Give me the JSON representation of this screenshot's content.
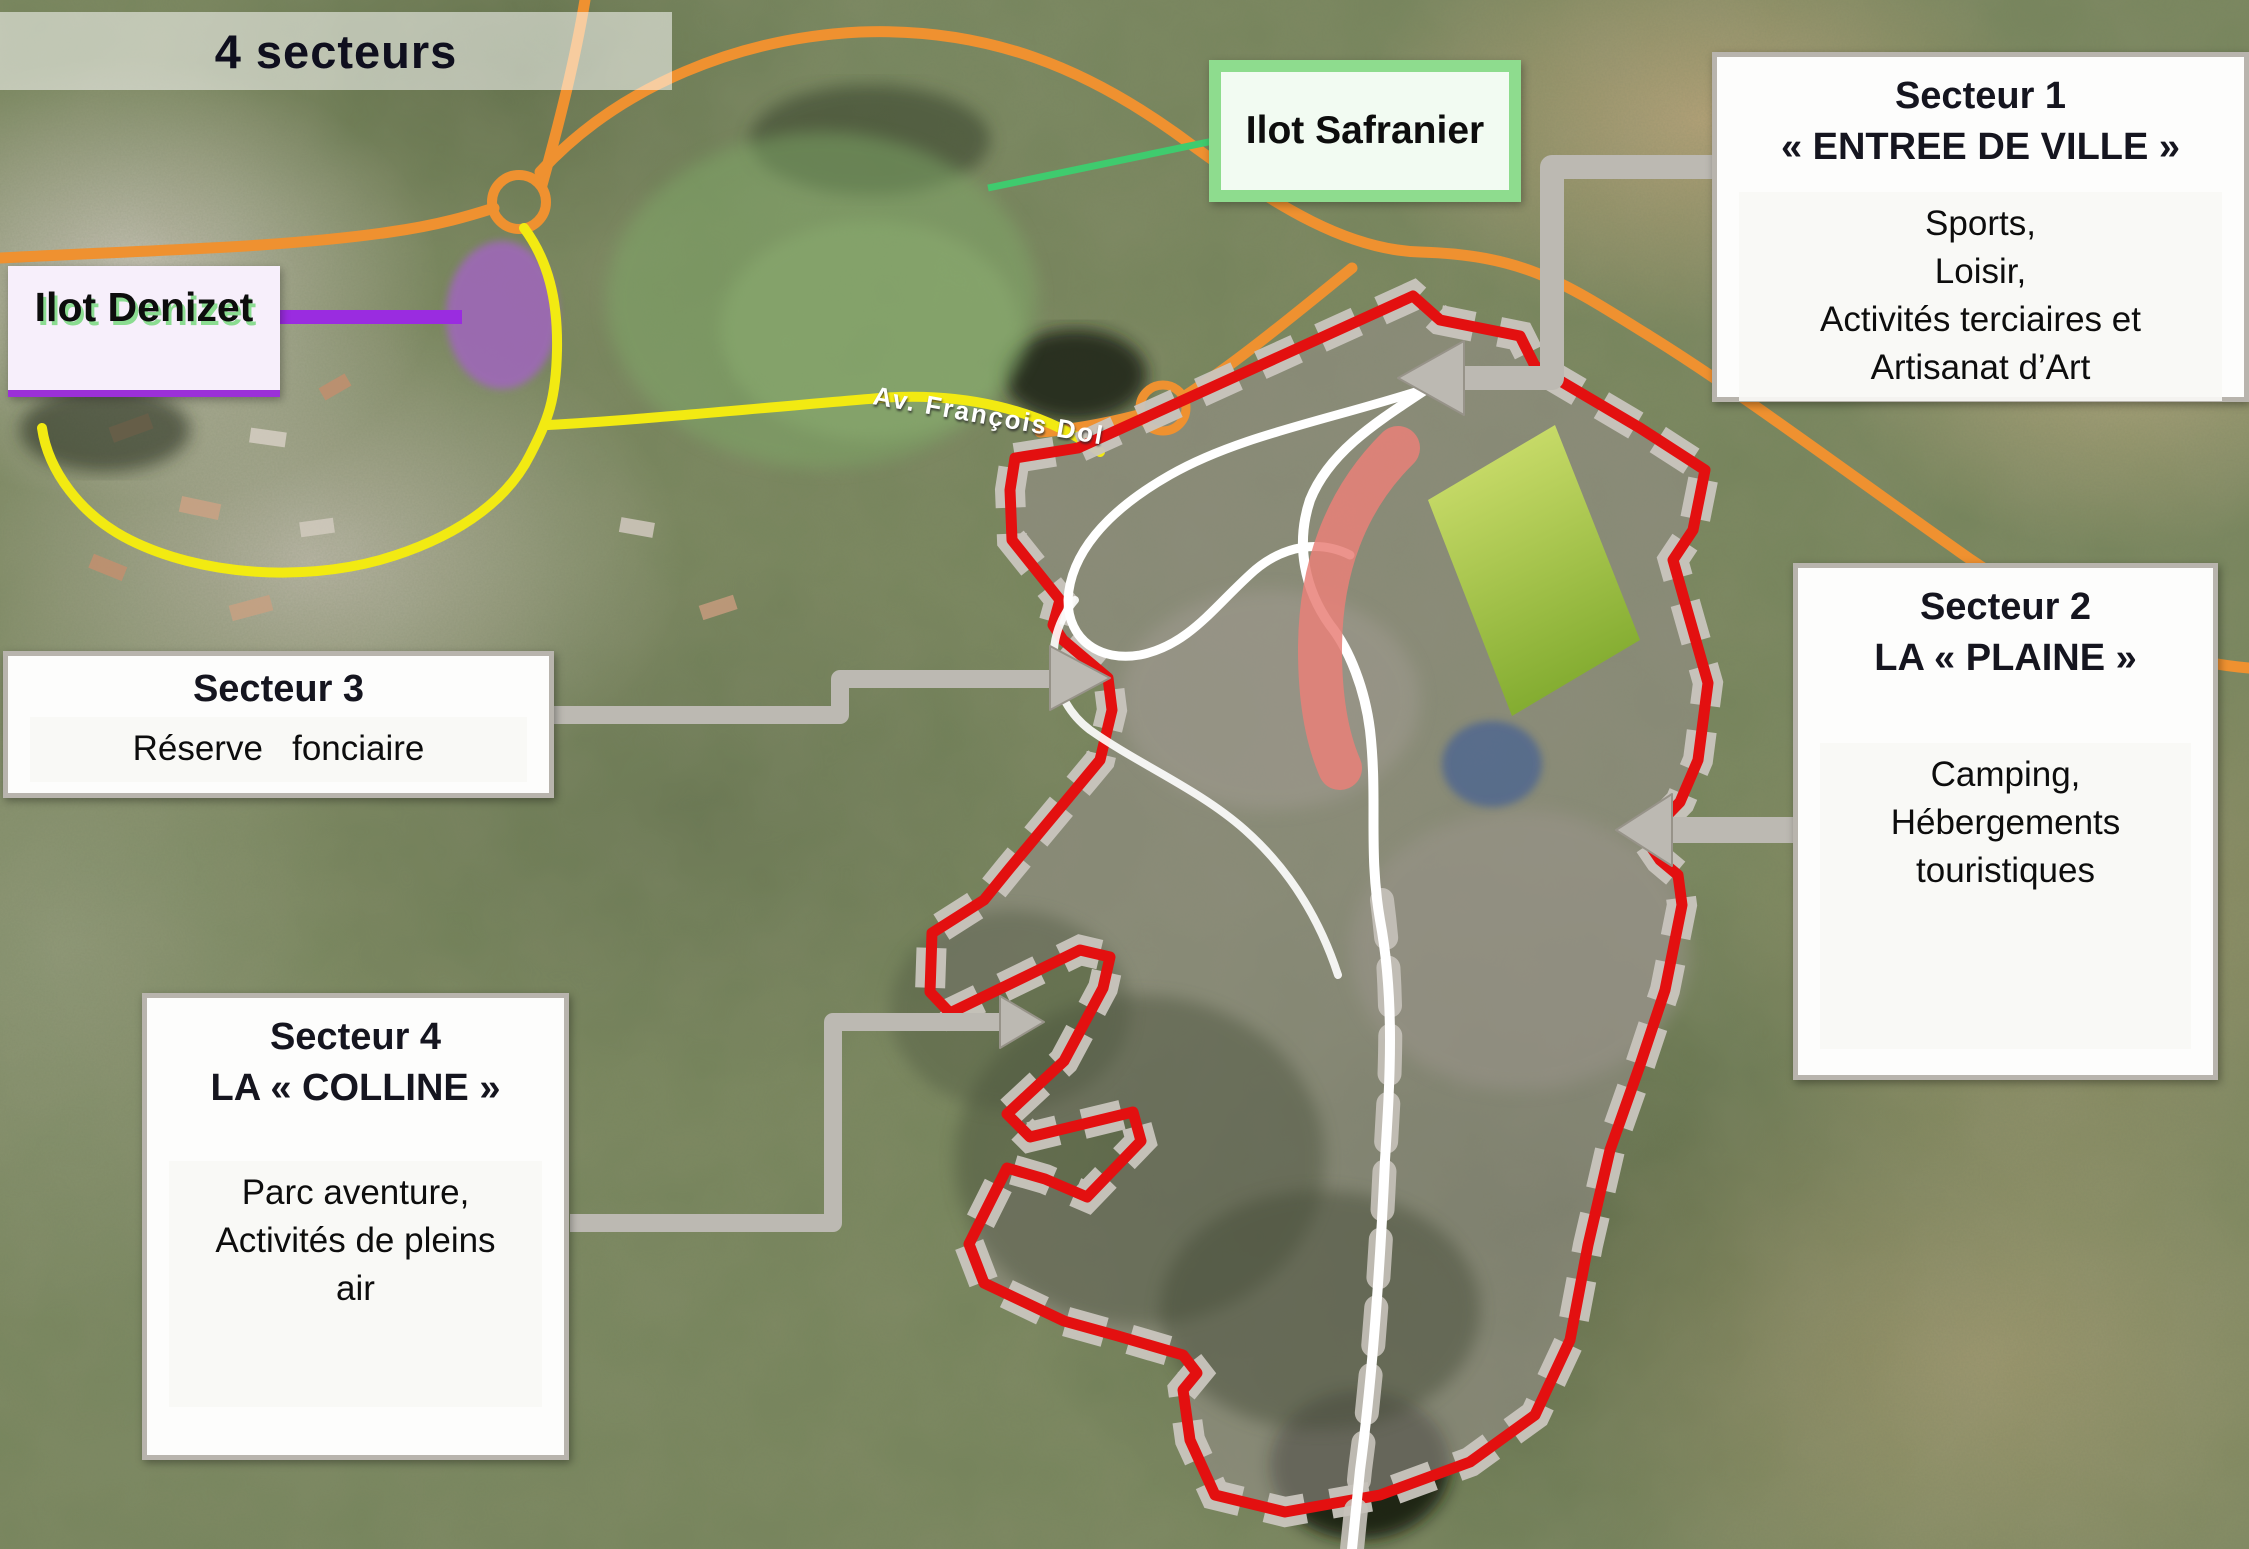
{
  "title": "4 secteurs",
  "labels": {
    "safranier": "Ilot Safranier",
    "denizet": "Ilot Denizet"
  },
  "road_label": "Av.  François Dol",
  "sectors": [
    {
      "title": "Secteur 1",
      "subtitle": "« ENTREE DE VILLE »",
      "activities": [
        "Sports,",
        "Loisir,",
        "Activités terciaires et",
        "Artisanat d’Art"
      ]
    },
    {
      "title": "Secteur 2",
      "subtitle": "LA « PLAINE »",
      "activities": [
        "Camping,",
        "Hébergements",
        "touristiques"
      ]
    },
    {
      "title": "Secteur 3",
      "subtitle": "",
      "activities": [
        "Réserve   fonciaire"
      ]
    },
    {
      "title": "Secteur 4",
      "subtitle": "LA « COLLINE »",
      "activities": [
        "Parc aventure,",
        "Activités de pleins",
        "air"
      ]
    }
  ],
  "colors": {
    "boundary_red": "#e31010",
    "crenellation_gray": "#c9c5be",
    "connector_gray": "#bcb9b2",
    "callout_border_gray": "#b8b4ad",
    "safranier_green_border": "#8edc8e",
    "safranier_zone_green": "#7fa868",
    "denizet_purple_border": "#9b30d8",
    "denizet_zone_purple": "#a066bd",
    "green_rectangle": "#a4c73d",
    "salmon_strip": "#e98078",
    "pond_blue": "#51688f",
    "road_orange": "#ef9130",
    "road_yellow": "#f2ea12",
    "road_white": "#ffffff"
  }
}
